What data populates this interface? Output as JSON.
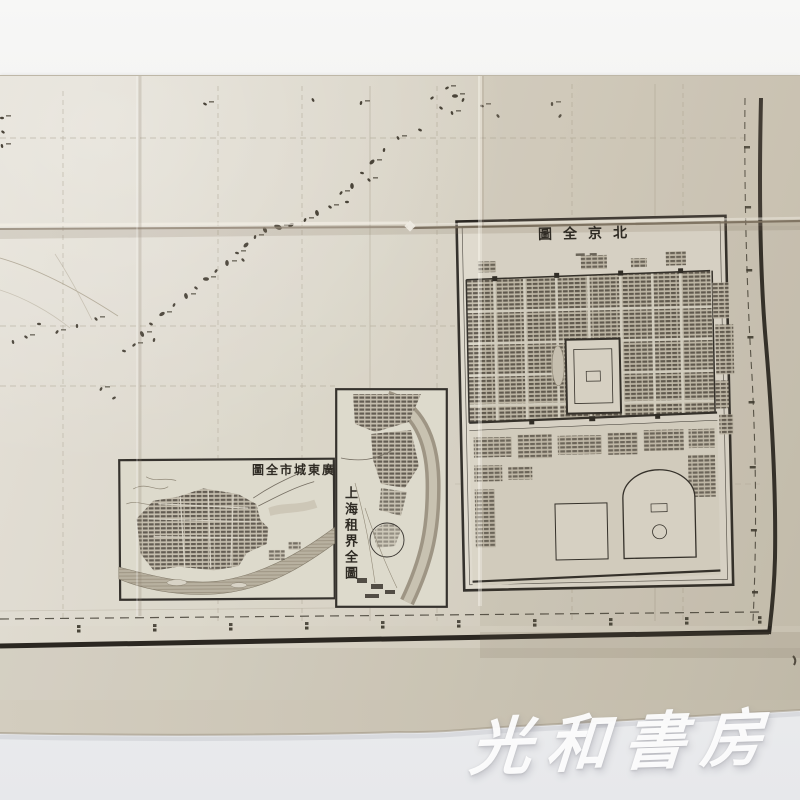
{
  "photo": {
    "description": "photograph of an antique folded Japanese atlas sheet of China with three city inset maps",
    "watermark_text": "光和書房",
    "background": {
      "top": "#f7f7f6",
      "bottom": "#e7e8eb"
    }
  },
  "map": {
    "paper_color": "#d6d1c3",
    "ink_color": "#322e27",
    "insets": [
      {
        "id": "beijing",
        "title": "北京全圖",
        "title_display": "圖全京北",
        "orientation": "horizontal-right-to-left"
      },
      {
        "id": "shanghai",
        "title": "上海租界全圖",
        "title_display": "上海租界全圖",
        "orientation": "vertical"
      },
      {
        "id": "canton",
        "title": "廣東城市全圖",
        "title_display": "圖全市城東廣",
        "orientation": "horizontal-right-to-left"
      }
    ]
  }
}
